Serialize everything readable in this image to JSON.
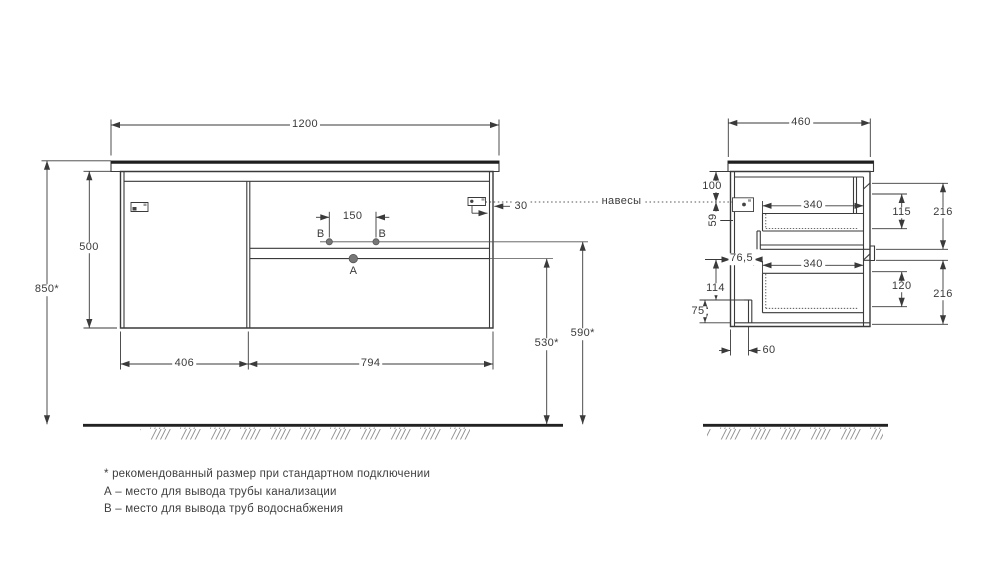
{
  "front_view": {
    "width": "1200",
    "height": "500",
    "mount_height": "850*",
    "door_width": "406",
    "drawer_width": "794",
    "supply_spacing": "150",
    "hanger_offset": "30",
    "drain_height": "530*",
    "supply_height": "590*",
    "point_a": "A",
    "point_b_left": "B",
    "point_b_right": "B"
  },
  "side_view": {
    "depth": "460",
    "hanger_top_offset": "100",
    "hanger_inset": "59",
    "drawer_inner_depth_top": "340",
    "drawer_inner_depth_bottom": "340",
    "back_clearance": "76,5",
    "bottom_clearance": "114",
    "plinth_height": "75",
    "plinth_depth": "60",
    "drawer_inner_height_top": "115",
    "front_height_top": "216",
    "drawer_inner_height_bottom": "120",
    "front_height_bottom": "216"
  },
  "hangers_label": "навесы",
  "notes": {
    "recommended": "* рекомендованный размер при стандартном подключении",
    "point_a": "А – место для вывода трубы канализации",
    "point_b": "В – место для вывода труб водоснабжения"
  }
}
